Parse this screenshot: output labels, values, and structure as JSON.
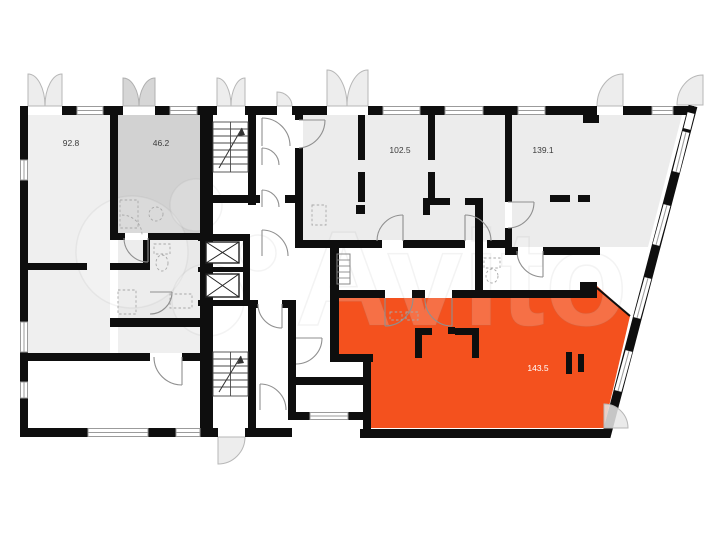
{
  "floorplan": {
    "watermark": {
      "text": "Avito",
      "opacity": 0.18
    },
    "colors": {
      "background": "#ffffff",
      "wall": "#0e0e0e",
      "room_light_gray": "#ececec",
      "room_medium_gray": "#d2d2d2",
      "room_pale_gray": "#e9e9e9",
      "highlight_orange": "#f4511e",
      "door_arc_line": "#8f8f8f"
    },
    "rooms": [
      {
        "name": "room-92-8",
        "area_label": "92.8",
        "fill": "#efefef",
        "label_color": "#3c3c3c"
      },
      {
        "name": "room-46-2",
        "area_label": "46.2",
        "fill": "#d2d2d2",
        "label_color": "#3c3c3c"
      },
      {
        "name": "room-102-5",
        "area_label": "102.5",
        "fill": "#ececec",
        "label_color": "#3c3c3c"
      },
      {
        "name": "room-139-1",
        "area_label": "139.1",
        "fill": "#ececec",
        "label_color": "#3c3c3c"
      },
      {
        "name": "room-143-5",
        "area_label": "143.5",
        "fill": "#f4511e",
        "label_color": "#ffffff"
      }
    ],
    "aux_fills": {
      "bathroom_block": "#e9e9e9",
      "hall_block": "#efefef"
    }
  }
}
